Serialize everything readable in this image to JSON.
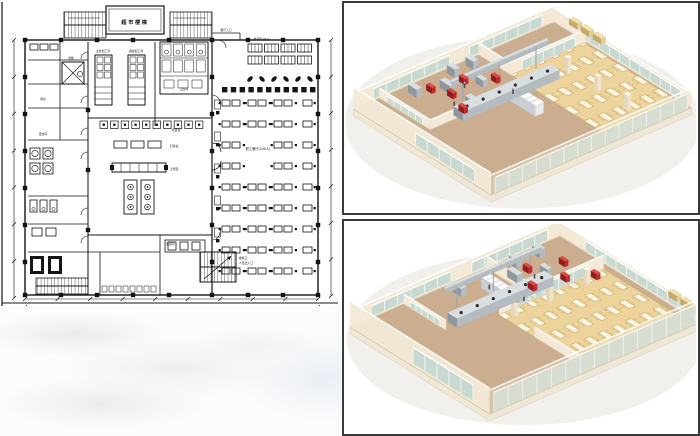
{
  "floor_plan": {
    "title_block": "超市楼梯",
    "labels": {
      "room_staple": "主食加工间",
      "room_side": "副食加工间",
      "toilet": "卫生间",
      "rest_area": "休息区(24人)",
      "entrance_top": "餐厅入口",
      "serving_counter": "售饭台",
      "prep_table": "打荷台",
      "cook_area": "烹饪区",
      "wash_area": "洗消间",
      "dining_hall": "职工餐厅(240人)",
      "storage": "库房",
      "dressing": "更衣间",
      "elevator": "货梯",
      "stair_exit_line1": "楼梯口",
      "stair_exit_line2": "人员出入口"
    },
    "colors": {
      "line": "#141414",
      "background": "#ffffff"
    }
  },
  "renders": {
    "colors": {
      "wall_cream": "#f3e9d6",
      "wall_tan": "#e6d0b2",
      "wall_top": "#fbf8f1",
      "floor_kitchen": "#cbae90",
      "floor_dining": "#ecd49c",
      "glass": "#c5d8d1",
      "glass_dark": "#a9c4bd",
      "steel": "#b4bcc1",
      "steel_light": "#d9dee1",
      "steel_dark": "#8e979d",
      "accent_red": "#c1272d",
      "table_top": "#fbf5e3",
      "chair": "#e2c687",
      "panel_border": "#3a3a3a"
    }
  }
}
